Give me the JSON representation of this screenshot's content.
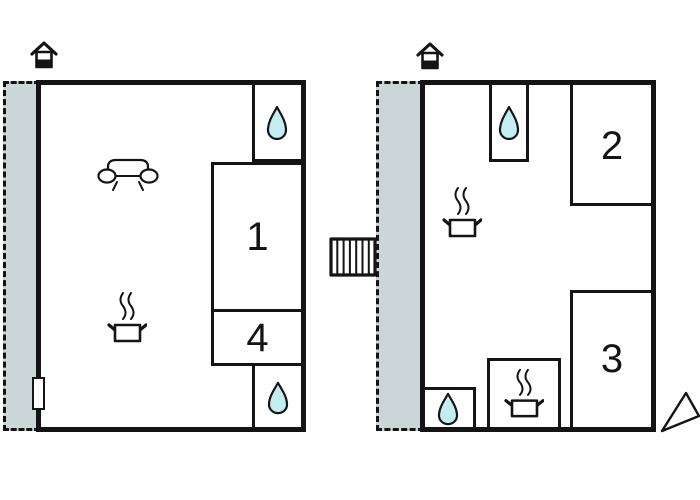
{
  "colors": {
    "wall": "#141414",
    "terrace_fill": "#cbd6d8",
    "water_drop_fill": "#c2eef2",
    "background": "#ffffff"
  },
  "left_unit": {
    "rooms": [
      {
        "label": "1"
      },
      {
        "label": "4"
      }
    ]
  },
  "right_unit": {
    "rooms": [
      {
        "label": "2"
      },
      {
        "label": "3"
      }
    ]
  },
  "icons": {
    "house-entrance-icon": "gabled house pictogram marking the entrance side",
    "water-drop-icon": "teardrop shape (bathroom / water point)",
    "cooking-pot-icon": "steaming pot (kitchen / stove)",
    "sofa-icon": "sofa outline (living room)",
    "stairs-icon": "hatched staircase connecting the two units",
    "direction-arrow-icon": "open triangular arrow at lower right"
  }
}
